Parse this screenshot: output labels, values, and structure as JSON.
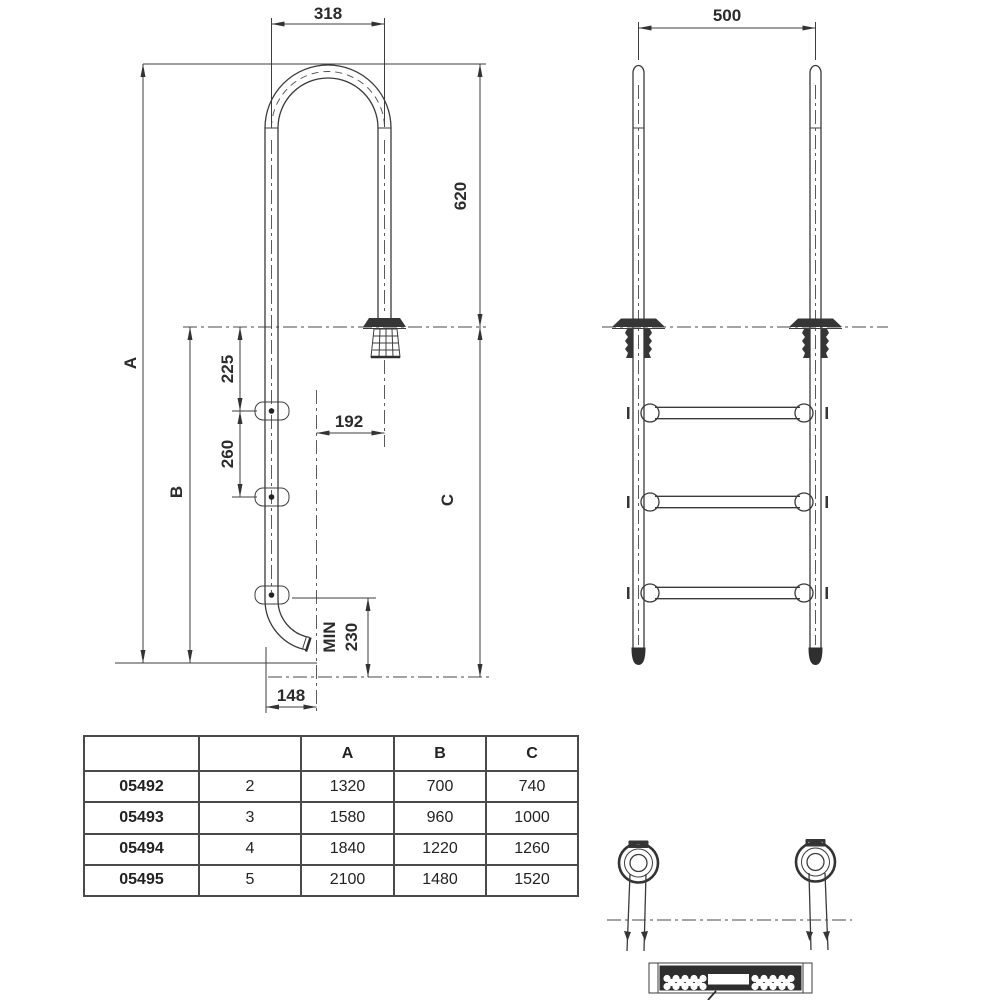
{
  "side_view": {
    "dim_top_width": "318",
    "dim_handrail_height": "620",
    "dim_overall": "A",
    "dim_deck_to_bottom": "B",
    "dim_rail_drop": "C",
    "dim_deck_to_first_rung": "225",
    "dim_rung_spacing": "260",
    "dim_wall_offset": "192",
    "dim_min_label": "MIN",
    "dim_min_value": "230",
    "dim_bottom_offset": "148"
  },
  "front_view": {
    "dim_rail_spacing": "500"
  },
  "table": {
    "headers": [
      "",
      "",
      "A",
      "B",
      "C"
    ],
    "rows": [
      {
        "model": "05492",
        "steps": "2",
        "a": "1320",
        "b": "700",
        "c": "740"
      },
      {
        "model": "05493",
        "steps": "3",
        "a": "1580",
        "b": "960",
        "c": "1000"
      },
      {
        "model": "05494",
        "steps": "4",
        "a": "1840",
        "b": "1220",
        "c": "1260"
      },
      {
        "model": "05495",
        "steps": "5",
        "a": "2100",
        "b": "1480",
        "c": "1520"
      }
    ]
  }
}
